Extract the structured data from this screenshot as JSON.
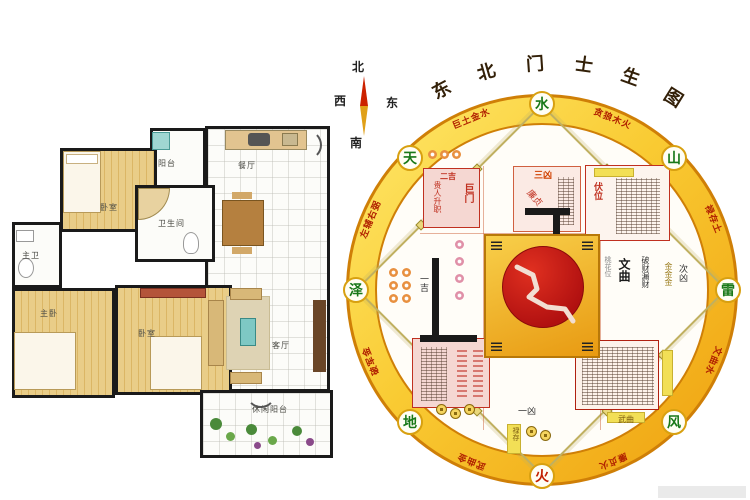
{
  "colors": {
    "ring_gold": "#f2b317",
    "ring_edge": "#cf7f07",
    "band_text_red": "#b02000",
    "node_green": "#187818",
    "node_fire_red": "#c22000",
    "center_disc_red": "#c01212",
    "wall_black": "#1a1a1a",
    "wood_floor": "#e5c47c",
    "pink_room": "#f5d7d2"
  },
  "compass": {
    "north": "北",
    "west": "西",
    "east": "东",
    "south": "南"
  },
  "floorplan": {
    "rooms": [
      {
        "label": "阳台"
      },
      {
        "label": "卧室"
      },
      {
        "label": "卫生间"
      },
      {
        "label": "主卫"
      },
      {
        "label": "主卧"
      },
      {
        "label": "卧室"
      },
      {
        "label": "餐厅"
      },
      {
        "label": "客厅"
      },
      {
        "label": "休闲阳台"
      }
    ]
  },
  "wheel": {
    "title": "东北门士生图",
    "title_chars": [
      "东",
      "北",
      "门",
      "士",
      "生",
      "图"
    ],
    "nodes": [
      {
        "char": "水",
        "color": "#187818"
      },
      {
        "char": "山",
        "color": "#187818"
      },
      {
        "char": "雷",
        "color": "#187818"
      },
      {
        "char": "风",
        "color": "#187818"
      },
      {
        "char": "火",
        "color": "#c22000"
      },
      {
        "char": "地",
        "color": "#187818"
      },
      {
        "char": "泽",
        "color": "#187818"
      },
      {
        "char": "天",
        "color": "#187818"
      }
    ],
    "ring_phrases": [
      "巨土金水",
      "贪狼木火",
      "禄存土",
      "文曲水",
      "廉贞火",
      "武曲金",
      "破军金",
      "左辅右弼"
    ],
    "labels": {
      "sanxiong": "三凶",
      "erji": "二吉",
      "jumen": "巨门",
      "guiren": "贵人升职",
      "lianzhen": "廉贞",
      "fuwei": "伏位",
      "wenqu": "文曲",
      "taohua": "桃花位",
      "pocai": "破财漏财",
      "jins": "金金金",
      "cixiong": "次凶",
      "yiji": "一吉",
      "yixiong": "一凶",
      "wuqu": "武曲",
      "lucun": "禄存"
    }
  }
}
